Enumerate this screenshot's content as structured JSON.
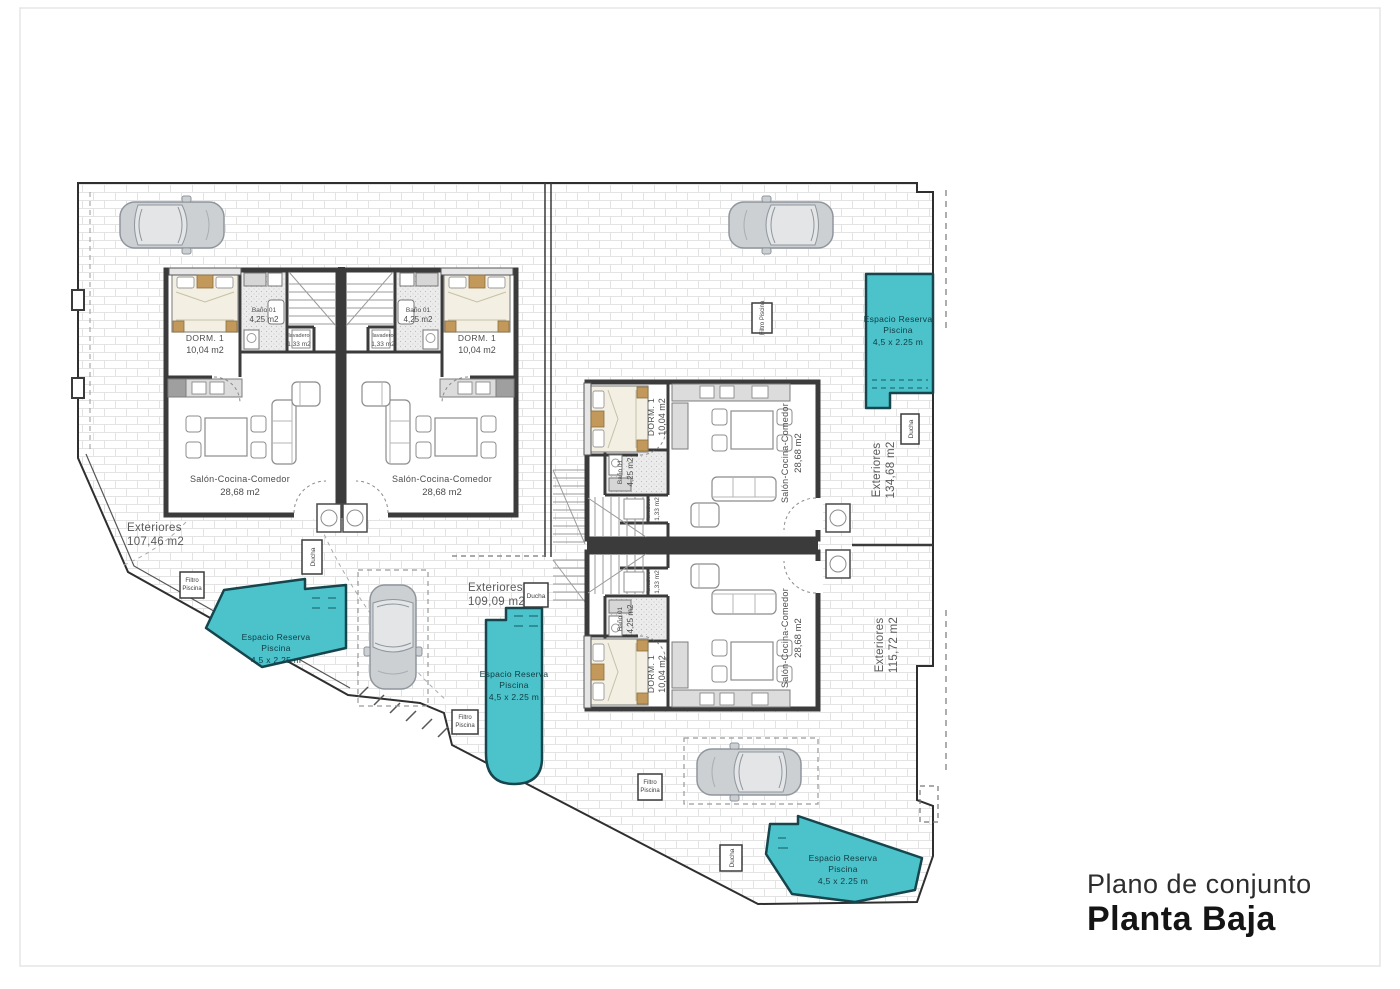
{
  "title": {
    "subtitle": "Plano de conjunto",
    "main": "Planta Baja"
  },
  "rooms": {
    "living": {
      "name": "Salón-Cocina-Comedor",
      "area": "28,68 m2"
    },
    "bedroom": {
      "name": "DORM. 1",
      "area": "10,04 m2"
    },
    "bathroom": {
      "name": "Baño 01",
      "area": "4,25 m2"
    },
    "laundry": {
      "name": "lavadero",
      "area": "1,33 m2"
    }
  },
  "exteriors": [
    {
      "name": "Exteriores",
      "area": "107,46 m2"
    },
    {
      "name": "Exteriores",
      "area": "109,09 m2"
    },
    {
      "name": "Exteriores",
      "area": "134,68 m2"
    },
    {
      "name": "Exteriores",
      "area": "115,72 m2"
    }
  ],
  "pool": {
    "line1": "Espacio Reserva",
    "line2": "Piscina",
    "line3": "4,5 x 2.25 m"
  },
  "equipment": {
    "filter_line1": "Filtro",
    "filter_line2": "Piscina",
    "filter_full": "Filtro Piscina",
    "shower": "Ducha"
  },
  "colors": {
    "pool_fill": "#4cc3cb",
    "pool_stroke": "#16454d",
    "wall": "#3b3b3b",
    "bed_accent": "#c2995a"
  }
}
